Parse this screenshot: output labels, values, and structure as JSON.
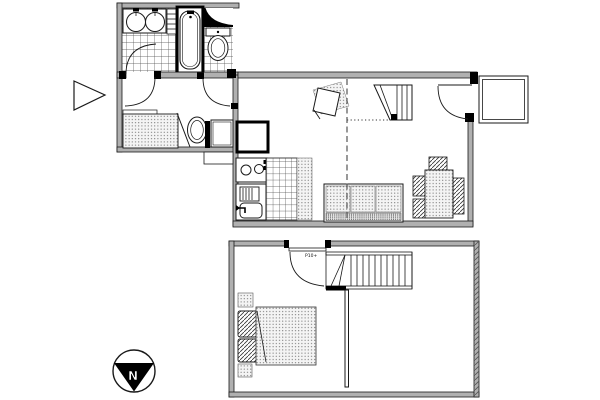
{
  "drawing": {
    "kind": "two-level apartment floor plan",
    "levels": [
      "upper-main-level",
      "lower-bedroom-level"
    ]
  },
  "compass": {
    "north_label": "N"
  },
  "annotations": {
    "stair_door_label": "P10+"
  },
  "colors": {
    "line": "#1a1a1a",
    "wall_fill": "#b0b0b0",
    "pattern_ink": "#555555",
    "black": "#000000",
    "background": "#ffffff"
  },
  "fixtures": {
    "upper_level": [
      "entry-direction-arrow",
      "double-washbasin",
      "towel-rail",
      "bathtub",
      "vanity-counter",
      "toilet",
      "hall-doors",
      "wardrobe",
      "wc-toilet",
      "washing-machine",
      "refrigerator",
      "cooktop",
      "kitchen-sink",
      "tiled-counter",
      "armchair",
      "winder-stairs-up",
      "loft-edge-dashed-line",
      "sofa",
      "dining-table",
      "dining-chairs",
      "entry-door",
      "balcony-landing"
    ],
    "lower_level": [
      "bedroom-door",
      "straight-stairs",
      "partition-wall",
      "double-bed",
      "pillows",
      "nightstands"
    ]
  }
}
